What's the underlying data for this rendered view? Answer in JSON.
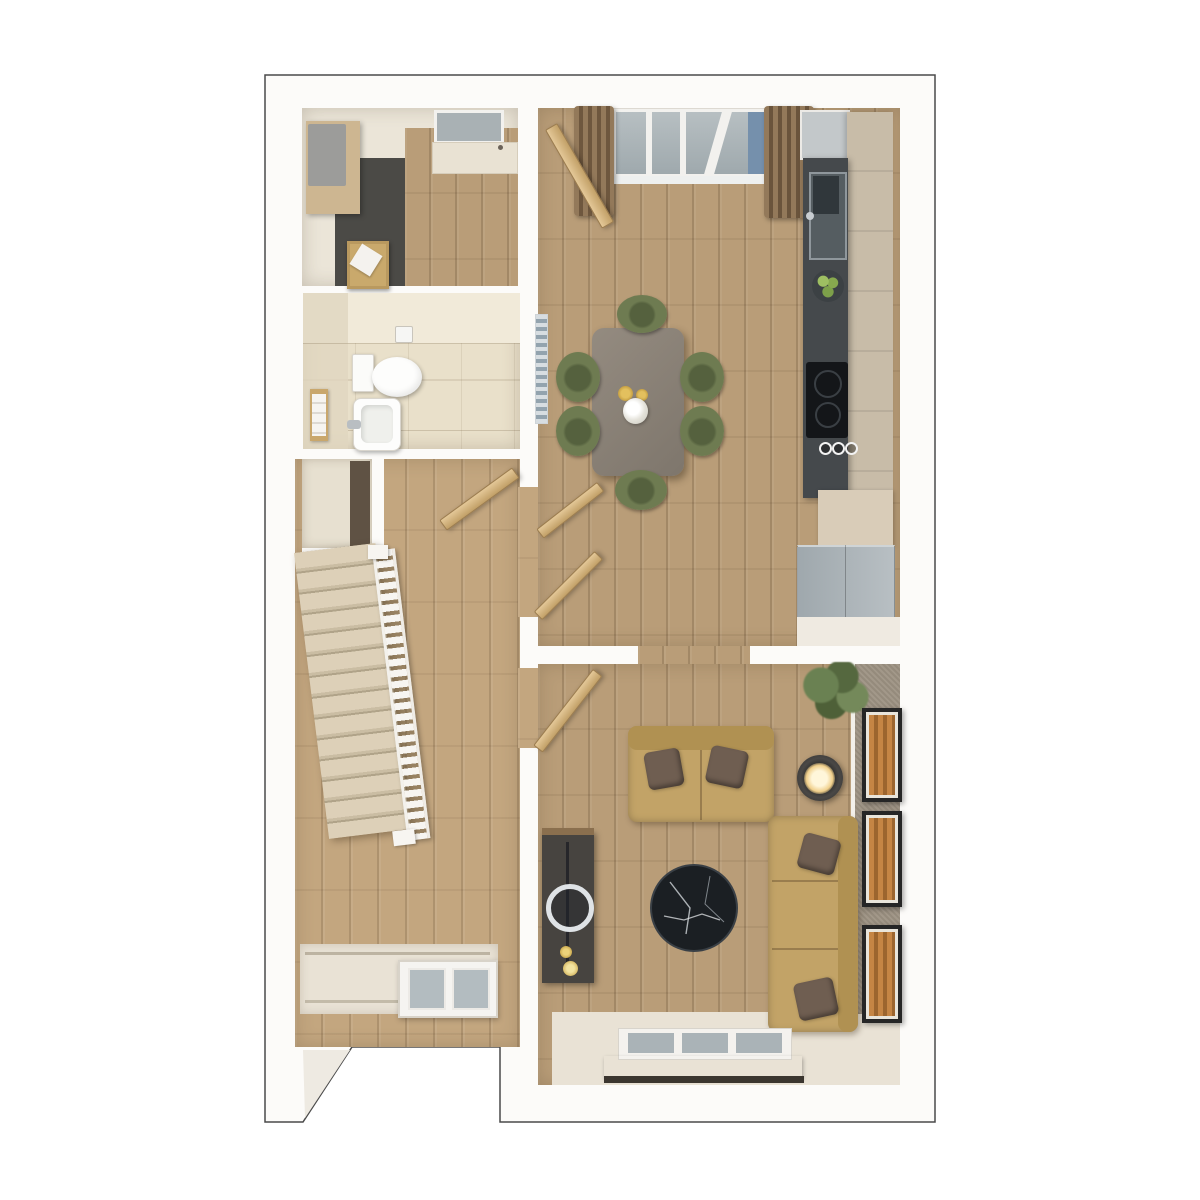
{
  "scene": {
    "title": "3D floor plan render — ground floor, top-down view",
    "style": "photoreal dollhouse render, no text labels visible"
  },
  "colors": {
    "wall": "#fcfbf9",
    "outline": "#4a4a4a",
    "wood-floor": "#b99d78",
    "hall-wood": "#c3a67f",
    "utility-dark-floor": "#4b4a46",
    "bathroom-tile": "#e9e0ca",
    "stair-carpet": "#dbceb6",
    "sofa": "#c2a367",
    "pillow": "#6f5e51",
    "chair-olive": "#6e7b51",
    "dining-table": "#8a8177",
    "counter-dark": "#45494c",
    "cabinet-tan": "#c8bca8",
    "fridge-gray": "#aab3b8",
    "curtain-brown": "#8a7154",
    "glass": "#a9b2b6",
    "glass-blue": "#7590ac",
    "accent-wall": "#9d9283",
    "frame-art": "#b97c3c",
    "plant-green": "#5a7045",
    "lamp-glow": "#f6e7bf",
    "coffee-table": "#1b1f23",
    "cream-floor": "#e9e2d5"
  },
  "rooms": [
    {
      "name": "Utility room",
      "items": [
        "worktop cabinet",
        "laundry basket",
        "window",
        "back door"
      ]
    },
    {
      "name": "Bathroom",
      "items": [
        "toilet",
        "wash basin",
        "towel shelf",
        "toilet-roll holder"
      ]
    },
    {
      "name": "Hallway and stairs",
      "items": [
        "carpeted staircase",
        "white banister",
        "under-stairs cupboard",
        "glazed front door",
        "open door"
      ]
    },
    {
      "name": "Kitchen / dining room",
      "items": [
        "glazed french doors",
        "two brown curtains",
        "radiator",
        "dining table",
        "six olive chairs",
        "vase of flowers",
        "two gold cups",
        "dark worktop with sink",
        "fruit bowl",
        "hob with knobs",
        "tall tan cabinets",
        "fridge freezer",
        "open doors"
      ]
    },
    {
      "name": "Living room",
      "items": [
        "two-seat sofa",
        "three-seat sofa",
        "four scatter pillows",
        "round marble coffee table",
        "media console with round mirror",
        "side table with lit lamp",
        "house plant",
        "three wall frames",
        "rear window with pelmet",
        "open door"
      ]
    }
  ],
  "furniture_counts": {
    "dining_chairs": 6,
    "sofas": 2,
    "wall_frames": 3,
    "doors_open": 5
  }
}
